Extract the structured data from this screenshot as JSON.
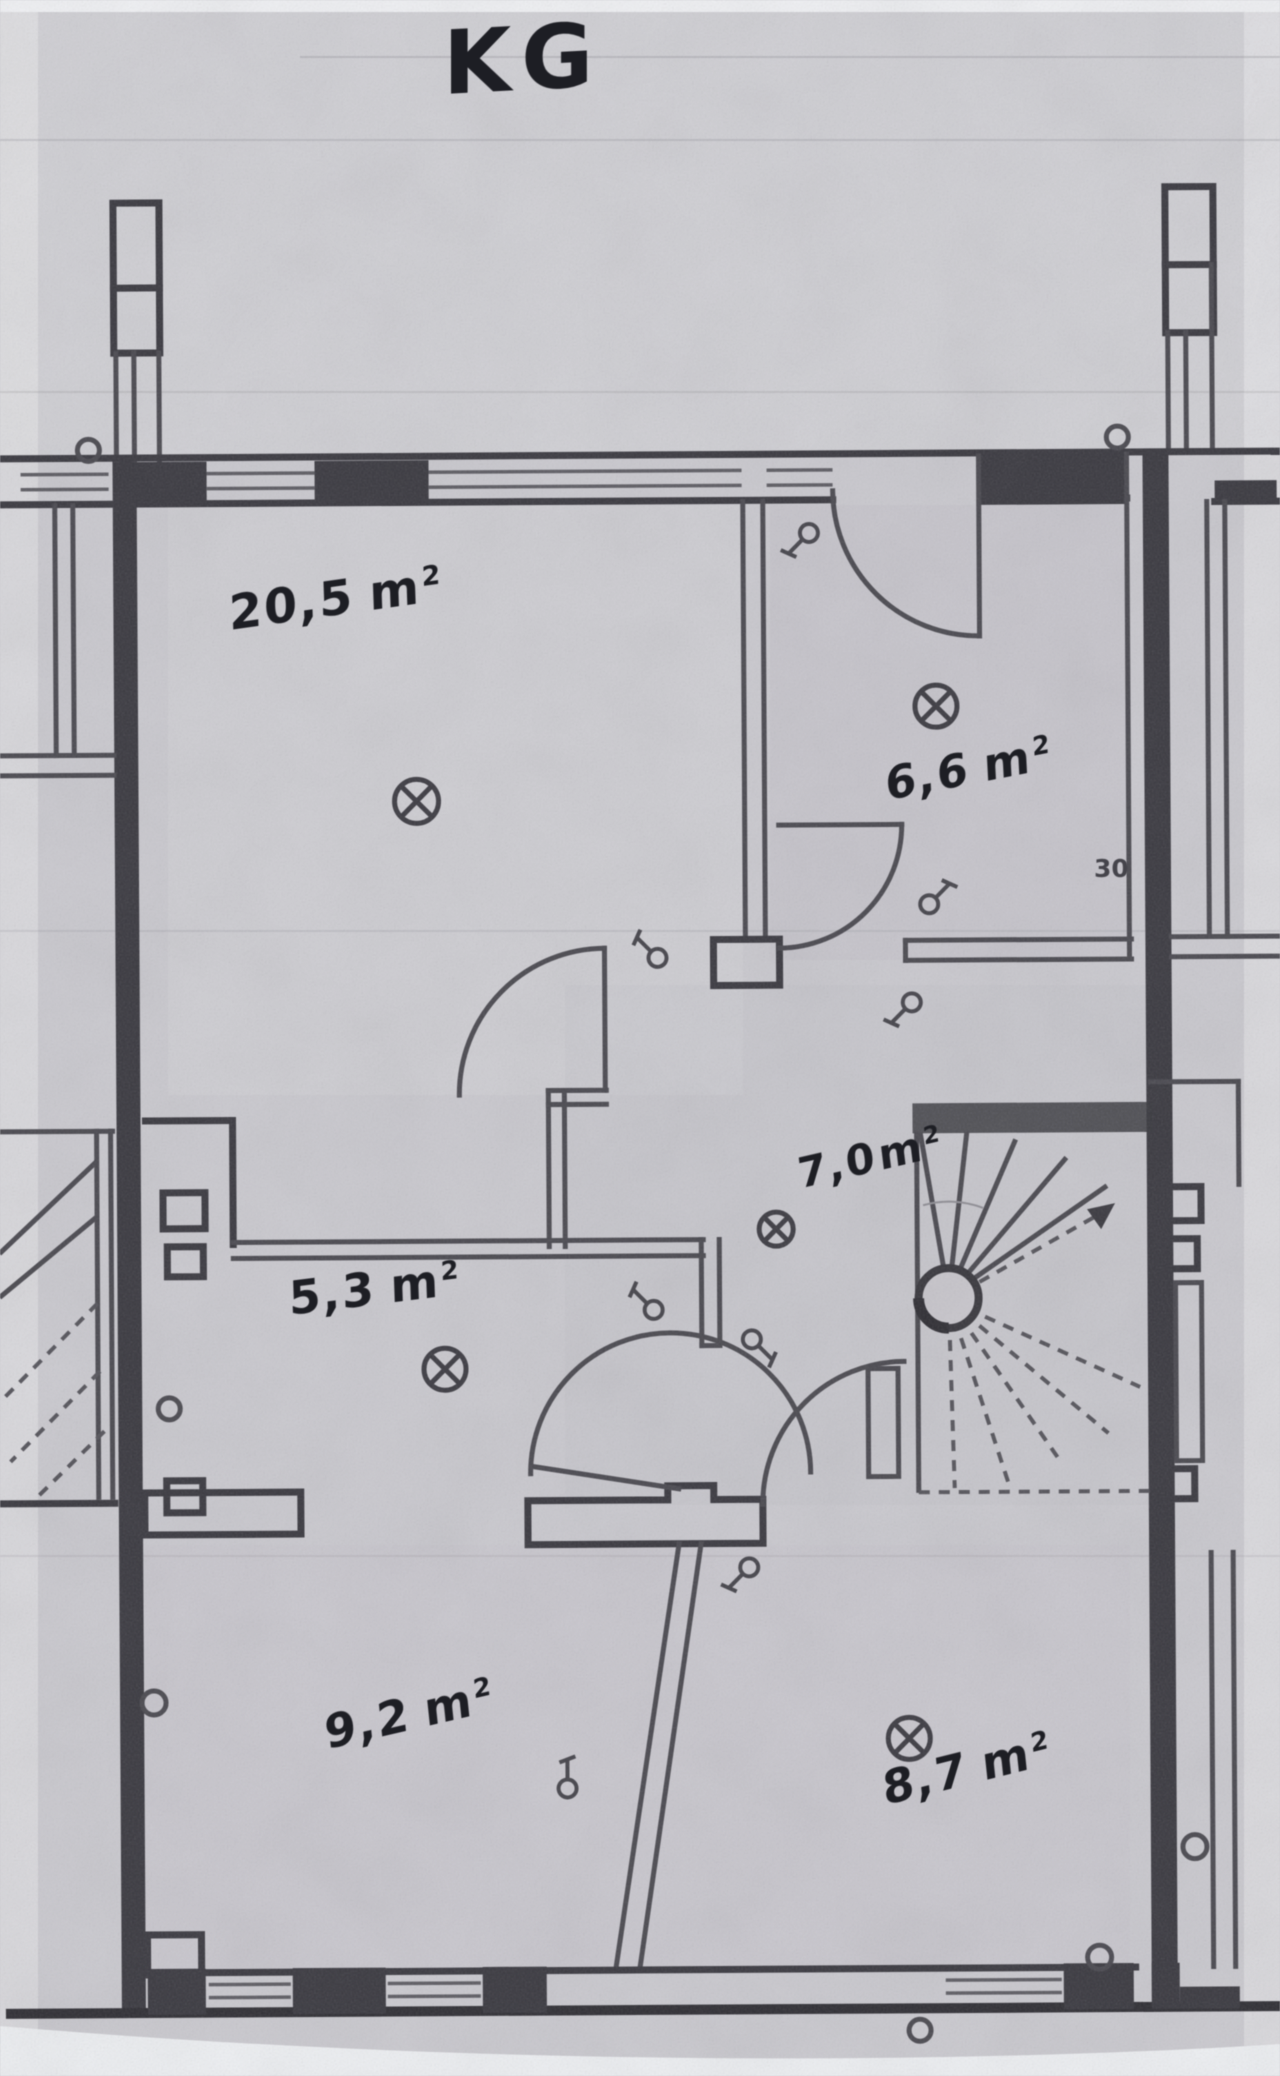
{
  "floor_plan": {
    "title": "KG",
    "rooms": [
      {
        "id": "room-top-left",
        "area_value": "20,5",
        "area_unit": "m",
        "area_exp": "2"
      },
      {
        "id": "room-top-right",
        "area_value": "6,6",
        "area_unit": "m",
        "area_exp": "2"
      },
      {
        "id": "hallway",
        "area_value": "7,0",
        "area_unit": "m",
        "area_exp": "2"
      },
      {
        "id": "room-middle-left",
        "area_value": "5,3",
        "area_unit": "m",
        "area_exp": "2"
      },
      {
        "id": "room-bottom-left",
        "area_value": "9,2",
        "area_unit": "m",
        "area_exp": "2"
      },
      {
        "id": "room-bottom-right",
        "area_value": "8,7",
        "area_unit": "m",
        "area_exp": "2"
      }
    ],
    "wall_dimension_label": "30",
    "colors": {
      "paper": "#c9c8ce",
      "ink": "#1d1e24",
      "wall": "#3a3940"
    }
  }
}
